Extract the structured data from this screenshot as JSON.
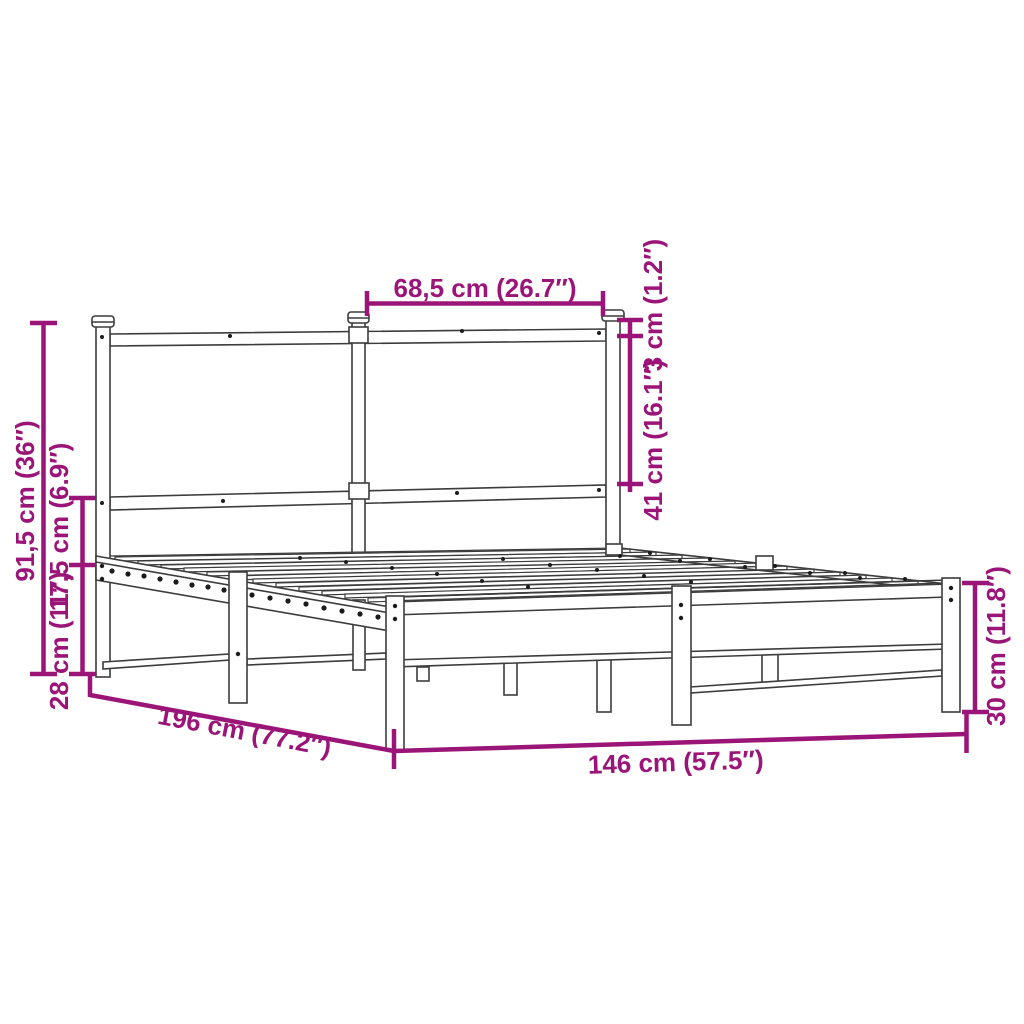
{
  "diagram": {
    "subject": "metal bed frame with headboard and slatted base - dimension drawing",
    "accent_color": "#9B1578",
    "line_color": "#3C3C3C",
    "background_color": "#FFFFFF",
    "labels": {
      "total_height": "91,5 cm (36″)",
      "headboard_rail_gap": "17,5 cm (6.9″)",
      "under_bed_clearance": "28 cm (11″)",
      "headboard_panel_width": "68,5 cm (26.7″)",
      "finial_height": "3 cm (1.2″)",
      "headboard_panel_height": "41 cm (16.1″)",
      "bed_length": "196 cm (77.2″)",
      "bed_width": "146 cm (57.5″)",
      "frame_side_height": "30 cm (11.8″)"
    }
  }
}
